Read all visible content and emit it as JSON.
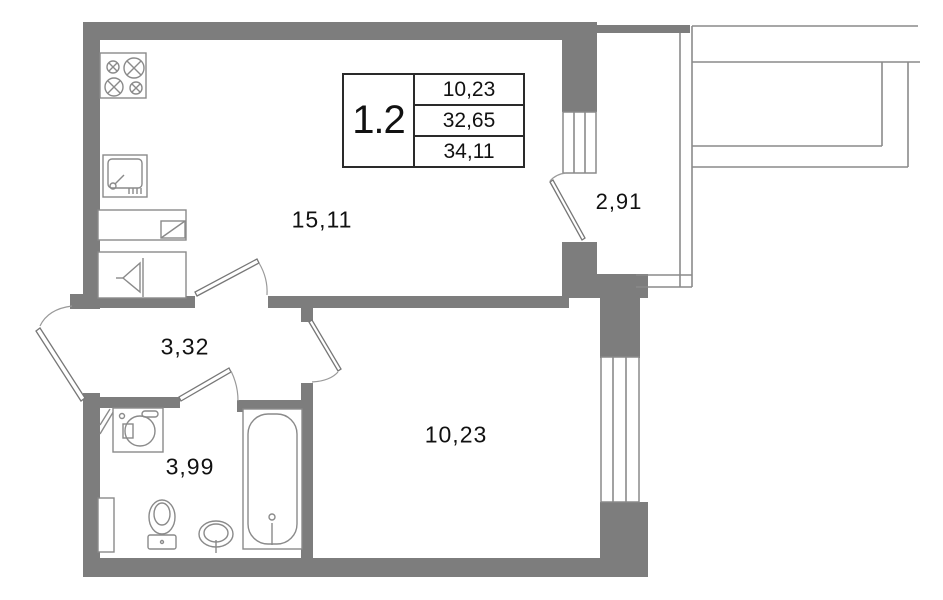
{
  "plan": {
    "unit": {
      "label": "1.2"
    },
    "info_table": {
      "rows": [
        {
          "value": "10,23"
        },
        {
          "value": "32,65"
        },
        {
          "value": "34,11"
        }
      ]
    },
    "rooms": {
      "living_kitchen": {
        "area": "15,11"
      },
      "hallway": {
        "area": "3,32"
      },
      "bathroom": {
        "area": "3,99"
      },
      "bedroom": {
        "area": "10,23"
      },
      "balcony": {
        "area": "2,91"
      }
    },
    "icons": [
      "stove-icon",
      "kitchen-sink-icon",
      "counter-icon",
      "vent-funnel-icon",
      "washing-machine-icon",
      "toilet-icon",
      "washbasin-icon",
      "bathtub-icon"
    ],
    "colors": {
      "wall": "#7d7d7d",
      "line": "#8a8a8a",
      "text": "#111111",
      "border": "#2a2a2a",
      "background": "#ffffff"
    }
  }
}
